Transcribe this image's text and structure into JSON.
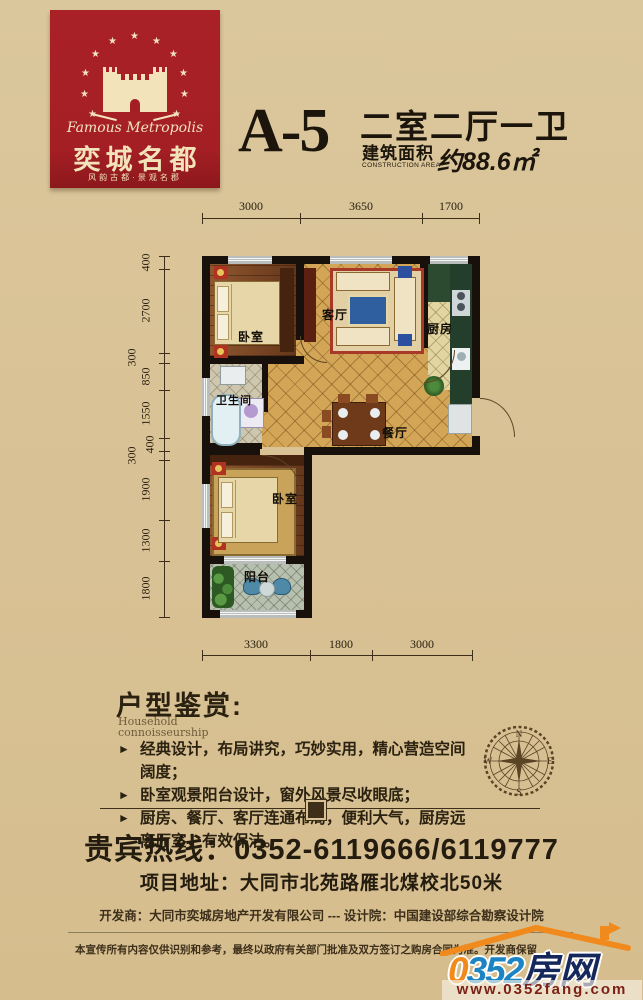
{
  "colors": {
    "background": "#d8c194",
    "brand_red": "#a41f24",
    "cream": "#f2e3bb",
    "ink": "#221a0e",
    "gold_tile": "#d2a557",
    "site_blue": "#1d84c4",
    "site_orange": "#f08a1d",
    "site_navy": "#16275c",
    "url_red": "#7c2016"
  },
  "brand": {
    "name_en": "Famous Metropolis",
    "name_cn": "奕城名都",
    "slogan": "风韵古都·景观名郡"
  },
  "unit": {
    "code": "A-5",
    "layout": "二室二厅一卫",
    "area_label": "建筑面积",
    "area_label_en": "CONSTRUCTION AREA",
    "area_value": "约88.6㎡"
  },
  "plan": {
    "rooms": {
      "bedroom1": "卧室",
      "living": "客厅",
      "kitchen": "厨房",
      "bath": "卫生间",
      "dining": "餐厅",
      "bedroom2": "卧室",
      "balcony": "阳台"
    },
    "dims_top": [
      "3000",
      "3650",
      "1700"
    ],
    "dims_bottom": [
      "3300",
      "1800",
      "3000"
    ],
    "dims_left": [
      "400",
      "2700",
      "300",
      "850",
      "1550",
      "400",
      "300",
      "1900",
      "1300",
      "1800"
    ]
  },
  "appreciation": {
    "title": "户型鉴赏:",
    "subtitle_line1": "Household",
    "subtitle_line2": "connoisseurship",
    "bullets": [
      "经典设计，布局讲究，巧妙实用，精心营造空间阔度；",
      "卧室观景阳台设计，窗外风景尽收眼底；",
      "厨房、餐厅、客厅连通布局，便利大气，厨房远离厅室，有效保洁。"
    ]
  },
  "compass": {
    "n": "N",
    "e": "E",
    "s": "S",
    "w": "W"
  },
  "contact": {
    "hotline": "贵宾热线：0352-6119666/6119777",
    "address": "项目地址：大同市北苑路雁北煤校北50米"
  },
  "footer": {
    "credits": "开发商：大同市奕城房地产开发有限公司 --- 设计院：中国建设部综合勘察设计院",
    "disclaimer": "本宣传所有内容仅供识别和参考，最终以政府有关部门批准及双方签订之购房合同为准。开发商保留",
    "site_num0": "0",
    "site_num": "352",
    "site_cn": "房网",
    "site_url": "www.0352fang.com"
  }
}
